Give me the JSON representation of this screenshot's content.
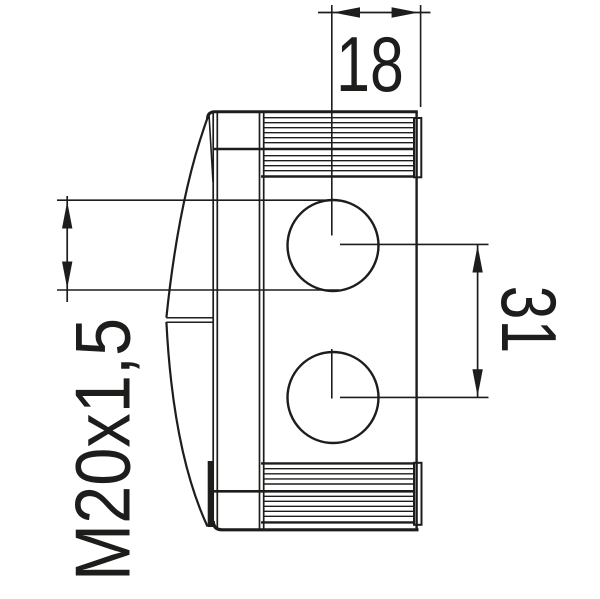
{
  "drawing": {
    "type": "technical-drawing-side-view",
    "subject": "junction-box with two cable entry glands",
    "colors": {
      "line": "#1d1d1b",
      "background": "#ffffff"
    },
    "dimensions": {
      "entry_offset_top": {
        "value": "18",
        "orientation": "horizontal"
      },
      "entry_spacing_right": {
        "value": "31",
        "orientation": "vertical"
      },
      "gland_thread_left": {
        "value": "M20x1,5",
        "orientation": "vertical"
      }
    }
  }
}
